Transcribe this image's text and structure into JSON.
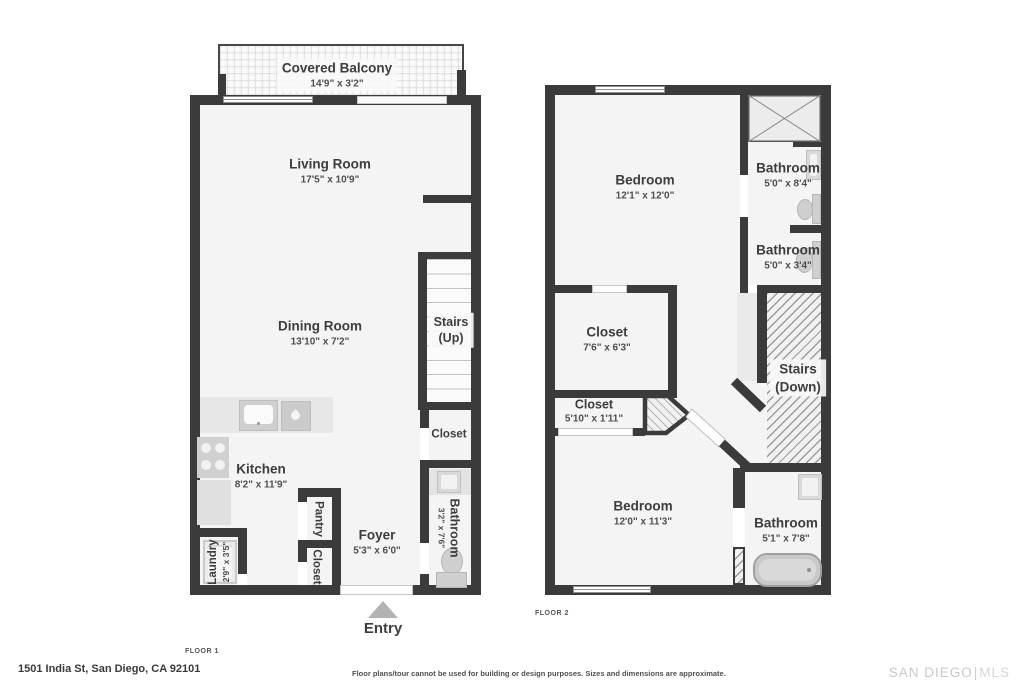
{
  "address": "1501 India St, San Diego, CA 92101",
  "disclaimer": "Floor plans/tour cannot be used for building or design purposes. Sizes and dimensions are approximate.",
  "brand": {
    "name": "SAN DIEGO",
    "suffix": "MLS"
  },
  "floor1": {
    "label": "FLOOR 1",
    "entry_label": "Entry",
    "balcony": {
      "name": "Covered Balcony",
      "dims": "14'9\" x 3'2\""
    },
    "living": {
      "name": "Living Room",
      "dims": "17'5\" x 10'9\""
    },
    "dining": {
      "name": "Dining Room",
      "dims": "13'10\" x 7'2\""
    },
    "stairs": {
      "name": "Stairs",
      "dir": "(Up)"
    },
    "closet_hall": {
      "name": "Closet"
    },
    "kitchen": {
      "name": "Kitchen",
      "dims": "8'2\" x 11'9\""
    },
    "pantry": {
      "name": "Pantry"
    },
    "closet_entry": {
      "name": "Closet"
    },
    "foyer": {
      "name": "Foyer",
      "dims": "5'3\" x 6'0\""
    },
    "laundry": {
      "name": "Laundry",
      "dims": "2'9\" x 3'5\""
    },
    "bathroom": {
      "name": "Bathroom",
      "dims": "3'2\" x 7'6\""
    }
  },
  "floor2": {
    "label": "FLOOR 2",
    "bedroom1": {
      "name": "Bedroom",
      "dims": "12'1\" x 12'0\""
    },
    "bathroom1": {
      "name": "Bathroom",
      "dims": "5'0\" x 8'4\""
    },
    "bathroom2": {
      "name": "Bathroom",
      "dims": "5'0\" x 3'4\""
    },
    "closet1": {
      "name": "Closet",
      "dims": "7'6\" x 6'3\""
    },
    "closet2": {
      "name": "Closet",
      "dims": "5'10\" x 1'11\""
    },
    "stairs": {
      "name": "Stairs",
      "dir": "(Down)"
    },
    "bedroom2": {
      "name": "Bedroom",
      "dims": "12'0\" x 11'3\""
    },
    "bathroom3": {
      "name": "Bathroom",
      "dims": "5'1\" x 7'8\""
    }
  },
  "colors": {
    "wall": "#3b3b3b",
    "floor": "#f4f4f4",
    "fixture": "#d6d6d6",
    "text": "#3d3d3d"
  }
}
